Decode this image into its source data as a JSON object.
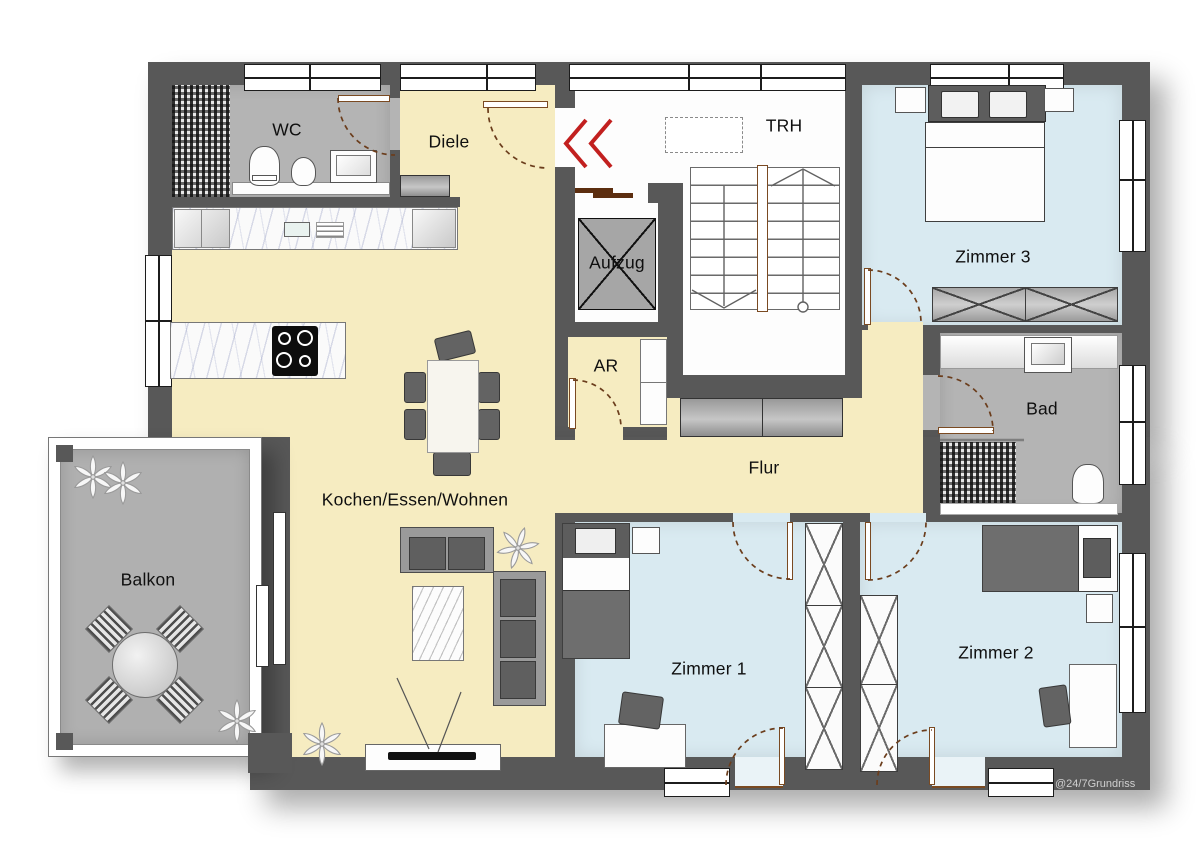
{
  "plan": {
    "rooms": {
      "wc": {
        "label": "WC"
      },
      "diele": {
        "label": "Diele"
      },
      "trh": {
        "label": "TRH"
      },
      "aufzug": {
        "label": "Aufzug"
      },
      "zimmer3": {
        "label": "Zimmer 3"
      },
      "ar": {
        "label": "AR"
      },
      "bad": {
        "label": "Bad"
      },
      "flur": {
        "label": "Flur"
      },
      "wohnen": {
        "label": "Kochen/Essen/Wohnen"
      },
      "balkon": {
        "label": "Balkon"
      },
      "zimmer1": {
        "label": "Zimmer 1"
      },
      "zimmer2": {
        "label": "Zimmer 2"
      }
    },
    "watermark": "@24/7Grundriss",
    "colors": {
      "wall": "#585858",
      "yellow": "#f6ecc1",
      "blue": "#d9eaf1",
      "gray": "#b4b4b4",
      "white": "#fdfdfd",
      "balcony": "#b0b0b0",
      "accent_red": "#c2201f",
      "doorbrown": "#7a4a22",
      "darkbrown": "#5c2e10"
    }
  }
}
